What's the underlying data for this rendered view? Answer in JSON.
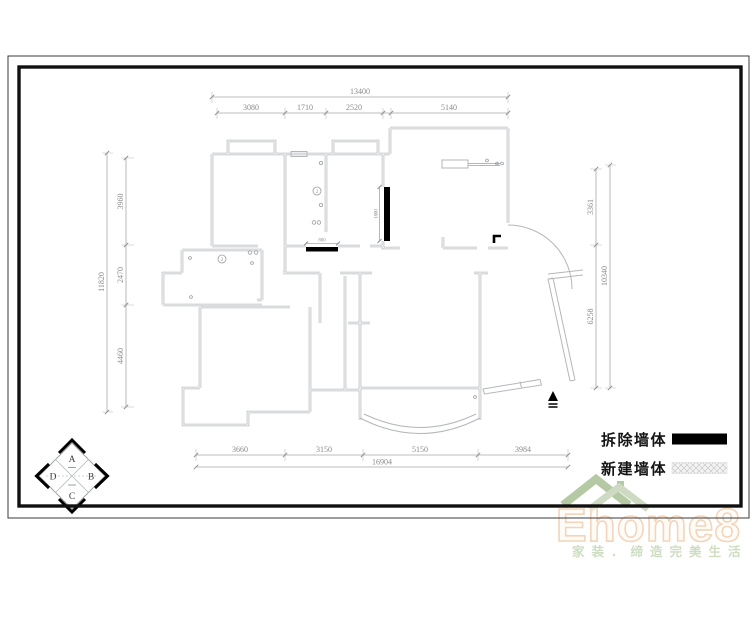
{
  "drawing": {
    "title_hint": "wall demolition floor plan",
    "dims_mm": {
      "top": {
        "overall": "13400",
        "segments": [
          "3080",
          "1710",
          "2520",
          "5140"
        ]
      },
      "left": {
        "overall": "11820",
        "segments": [
          "3960",
          "2470",
          "4460"
        ]
      },
      "right": {
        "overall": "10340",
        "segments": [
          "3361",
          "6258"
        ]
      },
      "bottom": {
        "overall": "16904",
        "segments": [
          "3660",
          "3150",
          "5150",
          "3984"
        ]
      },
      "inline": {
        "demolish_v": "1800",
        "demolish_h": "800"
      }
    },
    "annotations": {
      "circled_2": "2"
    },
    "legend": [
      {
        "label": "拆除墙体",
        "swatch": "solid-black"
      },
      {
        "label": "新建墙体",
        "swatch": "gray-crosshatch"
      }
    ],
    "compass": {
      "top": "A",
      "right": "B",
      "bottom": "C",
      "left": "D"
    },
    "watermark": {
      "logo": "Ehome8",
      "tagline": "家装．缔造完美生活"
    },
    "colors": {
      "wall_gray": "#b4b7ba",
      "dim_gray": "#8a8a8a",
      "demolish_black": "#000000",
      "logo_peach": "#f2d3b8",
      "logo_green": "#9db983",
      "tagline_green": "#ccdcbf"
    }
  }
}
